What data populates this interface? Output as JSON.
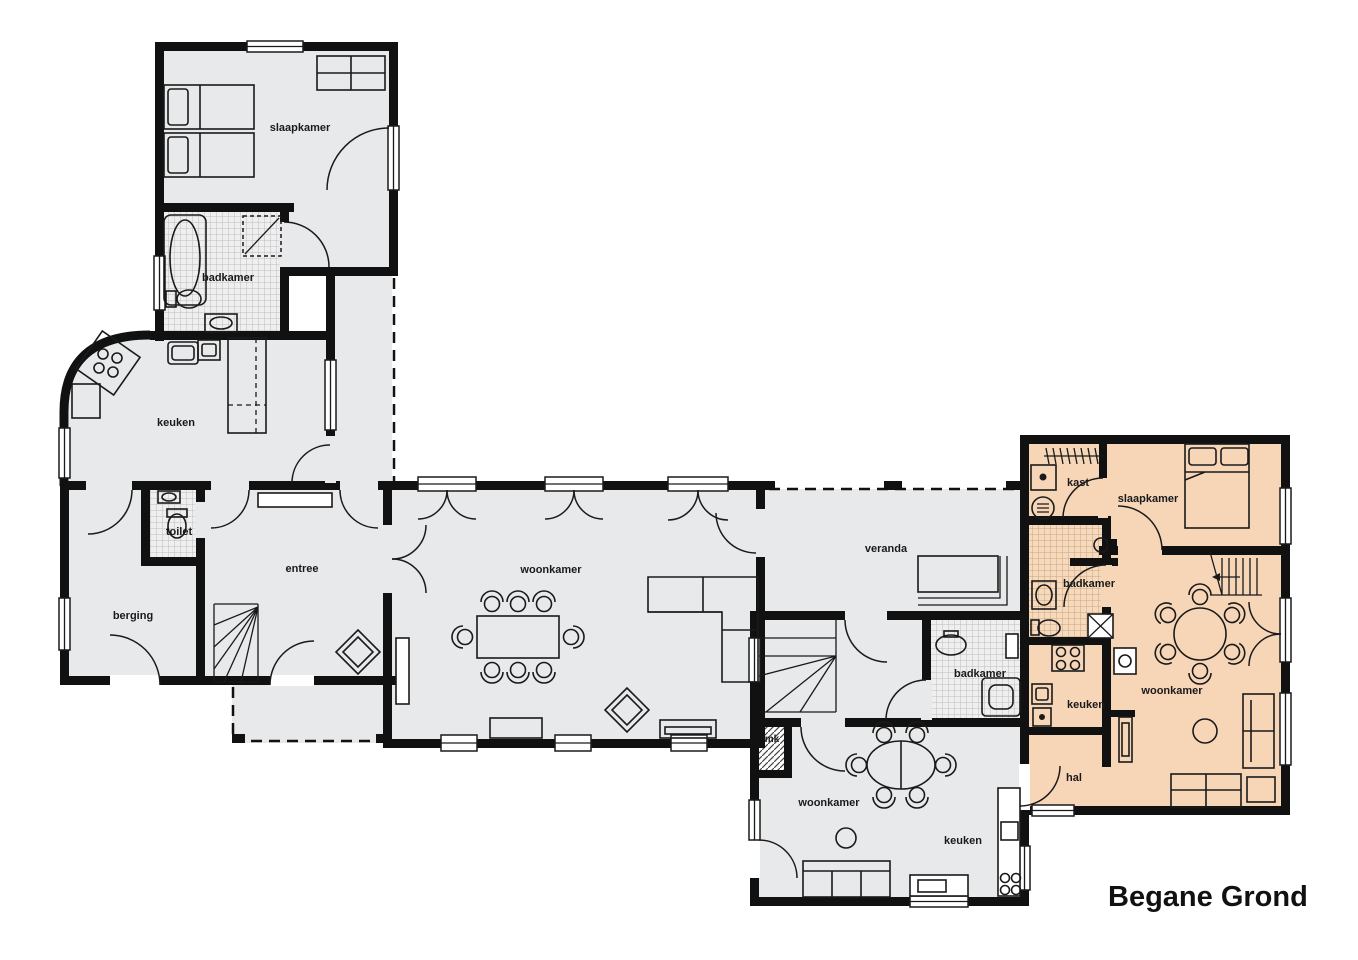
{
  "title": "Begane Grond",
  "colors": {
    "floor": "#e8e9ea",
    "highlight": "#f7d6b8",
    "wall": "#111111",
    "tile_gray": "#efefef",
    "tile_orange": "#f6dabe"
  },
  "labels": {
    "a_slaapkamer": "slaapkamer",
    "a_badkamer": "badkamer",
    "a_keuken": "keuken",
    "a_toilet": "toilet",
    "a_berging": "berging",
    "a_entree": "entree",
    "b_woonkamer": "woonkamer",
    "c_veranda": "veranda",
    "d_badkamer": "badkamer",
    "d_mk": "mk",
    "d_woonkamer": "woonkamer",
    "d_keuken": "keuken",
    "e_kast": "kast",
    "e_slaapkamer": "slaapkamer",
    "e_badkamer": "badkamer",
    "e_keuken": "keuken",
    "e_woonkamer": "woonkamer",
    "e_hal": "hal"
  },
  "units": {
    "left_house": {
      "rooms": [
        "slaapkamer",
        "badkamer",
        "keuken",
        "toilet",
        "berging",
        "entree"
      ]
    },
    "central_living": {
      "rooms": [
        "woonkamer"
      ]
    },
    "veranda": {
      "rooms": [
        "veranda"
      ]
    },
    "middle_house": {
      "rooms": [
        "badkamer",
        "mk",
        "woonkamer",
        "keuken"
      ]
    },
    "highlighted_apartment": {
      "rooms": [
        "kast",
        "slaapkamer",
        "badkamer",
        "keuken",
        "woonkamer",
        "hal"
      ],
      "highlight": true
    }
  }
}
